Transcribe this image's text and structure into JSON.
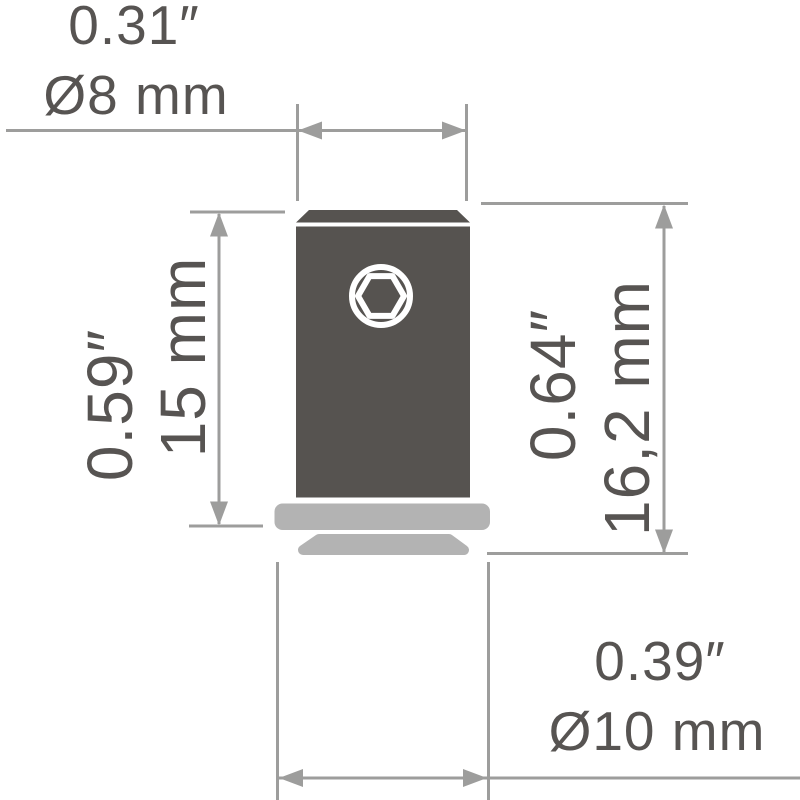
{
  "diagram_type": "product-dimension-drawing",
  "labels": {
    "width_top": {
      "inches": "0.31″",
      "metric": "Ø8 mm"
    },
    "height_left": {
      "inches": "0.59″",
      "metric": "15 mm"
    },
    "height_right": {
      "inches": "0.64″",
      "metric": "16,2 mm"
    },
    "diameter_bottom": {
      "inches": "0.39″",
      "metric": "Ø10 mm"
    }
  },
  "colors": {
    "background": "#ffffff",
    "part_dark": "#565350",
    "part_light": "#b3b3b3",
    "socket_outline": "#ffffff",
    "dimension_line": "#9d9d9c",
    "label_text": "#575452"
  },
  "icons": {
    "hex_socket": "hex-socket-icon"
  }
}
